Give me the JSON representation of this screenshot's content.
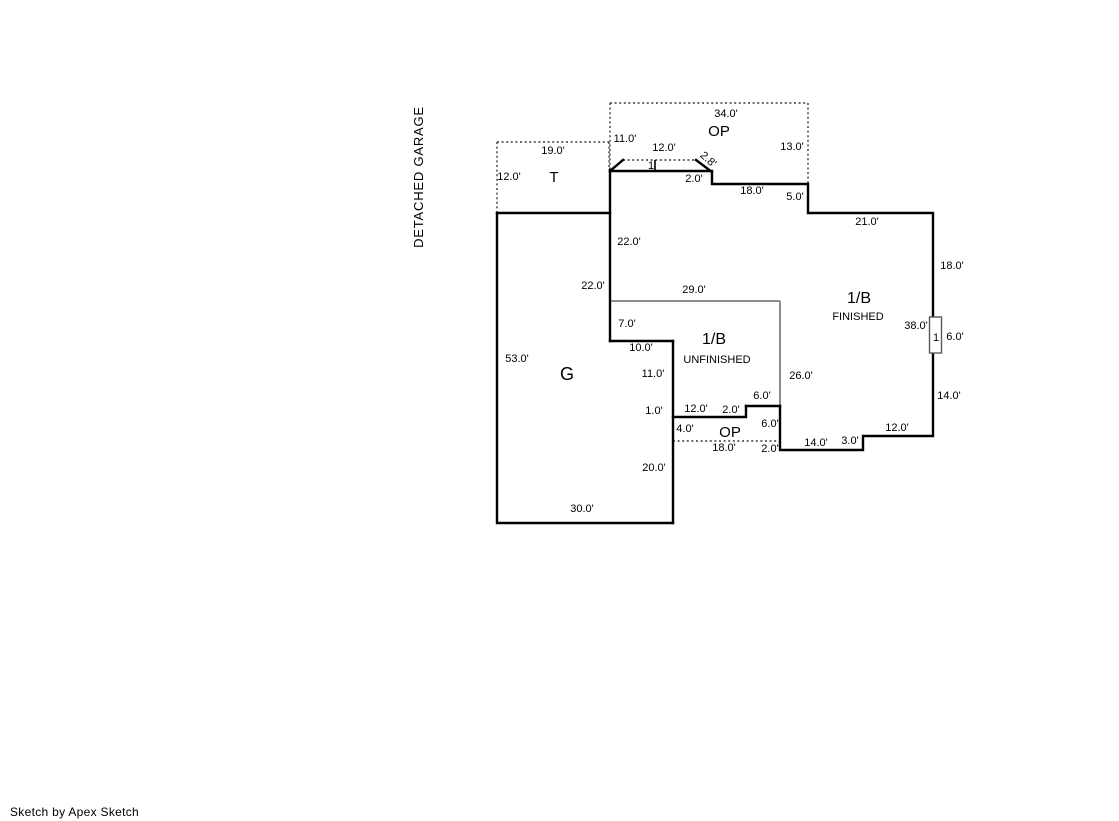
{
  "side_label": "DETACHED GARAGE",
  "footer": {
    "credit": "Sketch by Apex Sketch"
  },
  "colors": {
    "wall": "#000000",
    "area_separator": "#8e8e8e",
    "dashed_boundary": "#3a3a3a",
    "background": "#ffffff"
  },
  "areas": {
    "tool_shed": {
      "label": "T"
    },
    "open_porch_top": {
      "label": "OP"
    },
    "open_porch_bottom": {
      "label": "OP"
    },
    "garage": {
      "label": "G"
    },
    "finished": {
      "label": "1/B",
      "sublabel": "FINISHED"
    },
    "unfinished": {
      "label": "1/B",
      "sublabel": "UNFINISHED"
    }
  },
  "markers": {
    "bay": "1",
    "window": "1"
  },
  "dims": [
    {
      "id": "t-top",
      "text": "19.0'"
    },
    {
      "id": "t-left",
      "text": "12.0'"
    },
    {
      "id": "op-top-width",
      "text": "34.0'"
    },
    {
      "id": "op-top-left",
      "text": "11.0'"
    },
    {
      "id": "bay-top",
      "text": "12.0'"
    },
    {
      "id": "op-top-right",
      "text": "13.0'"
    },
    {
      "id": "bay-slant",
      "text": "2.8'"
    },
    {
      "id": "bay-step",
      "text": "2.0'"
    },
    {
      "id": "top-wall",
      "text": "18.0'"
    },
    {
      "id": "top-right-step",
      "text": "5.0'"
    },
    {
      "id": "top-edge",
      "text": "21.0'"
    },
    {
      "id": "finished-left-upper",
      "text": "22.0'"
    },
    {
      "id": "right-upper",
      "text": "18.0'"
    },
    {
      "id": "garage-right",
      "text": "22.0'"
    },
    {
      "id": "unfinished-top",
      "text": "29.0'"
    },
    {
      "id": "unfinished-left",
      "text": "7.0'"
    },
    {
      "id": "right-total",
      "text": "38.0'"
    },
    {
      "id": "window-height",
      "text": "6.0'"
    },
    {
      "id": "unfinished-step",
      "text": "10.0'"
    },
    {
      "id": "unfinished-left-lower",
      "text": "11.0'"
    },
    {
      "id": "finished-mid-left",
      "text": "26.0'"
    },
    {
      "id": "garage-left",
      "text": "53.0'"
    },
    {
      "id": "right-lower",
      "text": "14.0'"
    },
    {
      "id": "porch-step-top",
      "text": "6.0'"
    },
    {
      "id": "porch-notch",
      "text": "1.0'"
    },
    {
      "id": "porch-top-width",
      "text": "12.0'"
    },
    {
      "id": "porch-step",
      "text": "2.0'"
    },
    {
      "id": "porch-right-upper",
      "text": "6.0'"
    },
    {
      "id": "porch-left",
      "text": "4.0'"
    },
    {
      "id": "bottom-right-width",
      "text": "12.0'"
    },
    {
      "id": "bottom-step",
      "text": "3.0'"
    },
    {
      "id": "bottom-width",
      "text": "14.0'"
    },
    {
      "id": "porch-bottom-width",
      "text": "18.0'"
    },
    {
      "id": "porch-right-lower",
      "text": "2.0'"
    },
    {
      "id": "garage-right-lower",
      "text": "20.0'"
    },
    {
      "id": "garage-bottom",
      "text": "30.0'"
    }
  ]
}
